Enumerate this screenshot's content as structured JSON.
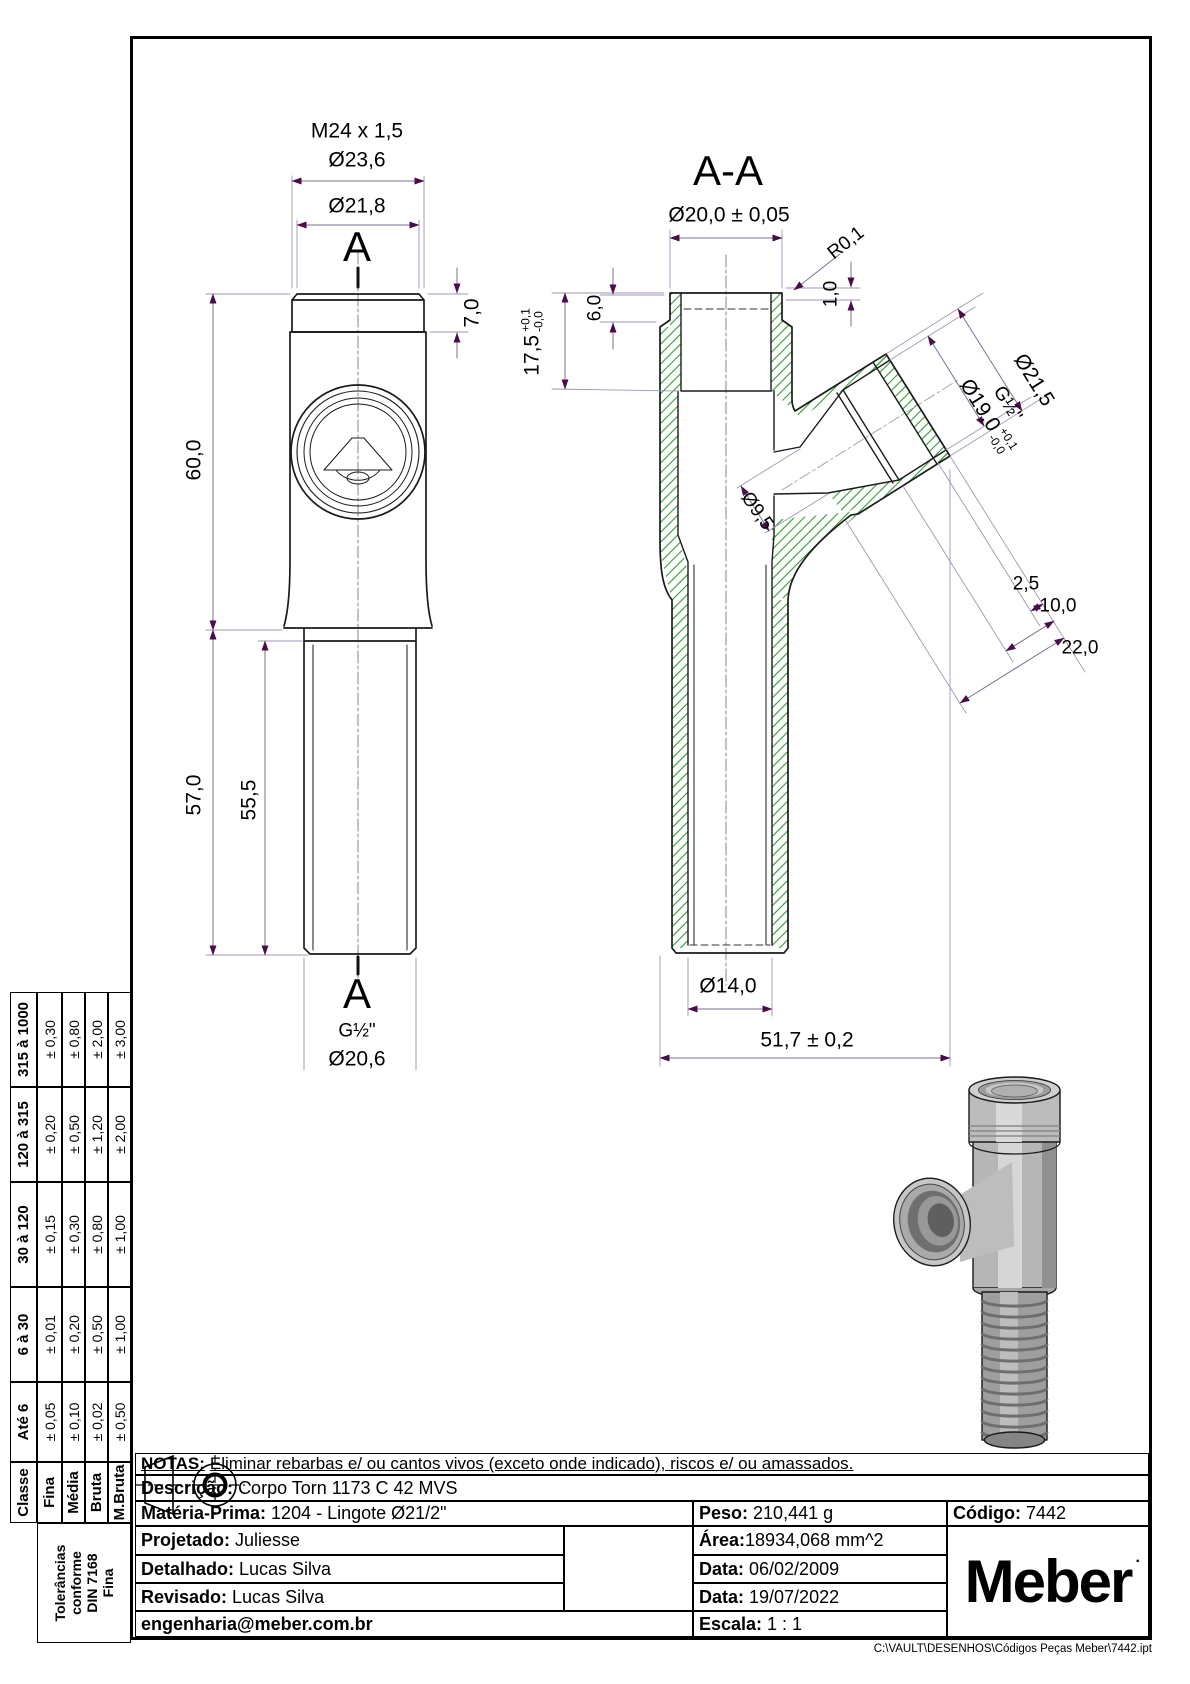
{
  "colors": {
    "outline": "#1a1a1a",
    "dimension": "#7d6f91",
    "arrow": "#4a0d4a",
    "hatch": "#2f9e2f",
    "centerline": "#777777",
    "render_gray": "#b6b6b6"
  },
  "front_view": {
    "section_marker_top": "A",
    "section_marker_bottom": "A",
    "dims": {
      "thread_top": "M24 x 1,5",
      "dia_outer": "Ø23,6",
      "dia_inner": "Ø21,8",
      "cap_height": "7,0",
      "body_height": "60,0",
      "stem_height": "57,0",
      "thread_length": "55,5",
      "thread_bottom": "G½\"",
      "dia_bottom": "Ø20,6"
    }
  },
  "section_view": {
    "title": "A-A",
    "dims": {
      "dia_top": "Ø20,0 ± 0,05",
      "radius_edge": "R0,1",
      "lip": "1,0",
      "relief_depth": "6,0",
      "bore_depth": "17,5",
      "bore_depth_plus": "+0,1",
      "bore_depth_minus": "-0,0",
      "branch_dia_outer": "Ø21,5",
      "branch_thread": "G½\"",
      "branch_dia_bore": "Ø19,0",
      "branch_bore_plus": "+0,1",
      "branch_bore_minus": "-0,0",
      "cross_hole": "Ø9,5",
      "face_ring": "2,5",
      "thread_depth": "10,0",
      "branch_depth": "22,0",
      "stem_bore": "Ø14,0",
      "overall_length": "51,7 ± 0,2"
    }
  },
  "tolerance_table": {
    "side_note_lines": [
      "Tolerâncias",
      "conforme",
      "DIN 7168",
      "Fina"
    ],
    "headers": [
      "Classe",
      "Até 6",
      "6 à 30",
      "30 à 120",
      "120 à 315",
      "315 à 1000"
    ],
    "rows": [
      {
        "label": "Fina",
        "values": [
          "± 0,05",
          "± 0,01",
          "± 0,15",
          "± 0,20",
          "± 0,30"
        ]
      },
      {
        "label": "Média",
        "values": [
          "± 0,10",
          "± 0,20",
          "± 0,30",
          "± 0,50",
          "± 0,80"
        ]
      },
      {
        "label": "Bruta",
        "values": [
          "± 0,02",
          "± 0,50",
          "± 0,80",
          "± 1,20",
          "± 2,00"
        ]
      },
      {
        "label": "M.Bruta",
        "values": [
          "± 0,50",
          "± 1,00",
          "± 1,00",
          "± 2,00",
          "± 3,00"
        ]
      }
    ]
  },
  "title_block": {
    "notas_label": "NOTAS:",
    "notas_text": "Eliminar rebarbas e/ ou cantos vivos (exceto onde indicado), riscos e/ ou amassados.",
    "descricao_label": "Descrição:",
    "descricao_value": "Corpo Torn 1173 C 42 MVS",
    "materia_label": "Matéria-Prima:",
    "materia_value": "1204 - Lingote Ø21/2\"",
    "peso_label": "Peso:",
    "peso_value": "210,441 g",
    "codigo_label": "Código:",
    "codigo_value": "7442",
    "projetado_label": "Projetado:",
    "projetado_value": "Juliesse",
    "detalhado_label": "Detalhado:",
    "detalhado_value": "Lucas Silva",
    "revisado_label": "Revisado:",
    "revisado_value": "Lucas Silva",
    "email": "engenharia@meber.com.br",
    "area_label": "Área:",
    "area_value": "18934,068 mm^2",
    "data1_label": "Data:",
    "data1_value": "06/02/2009",
    "data2_label": "Data:",
    "data2_value": "19/07/2022",
    "escala_label": "Escala:",
    "escala_value": "1 : 1",
    "logo": "Meber",
    "logo_dot": "."
  },
  "footer_path": "C:\\VAULT\\DESENHOS\\Códigos Peças Meber\\7442.ipt"
}
